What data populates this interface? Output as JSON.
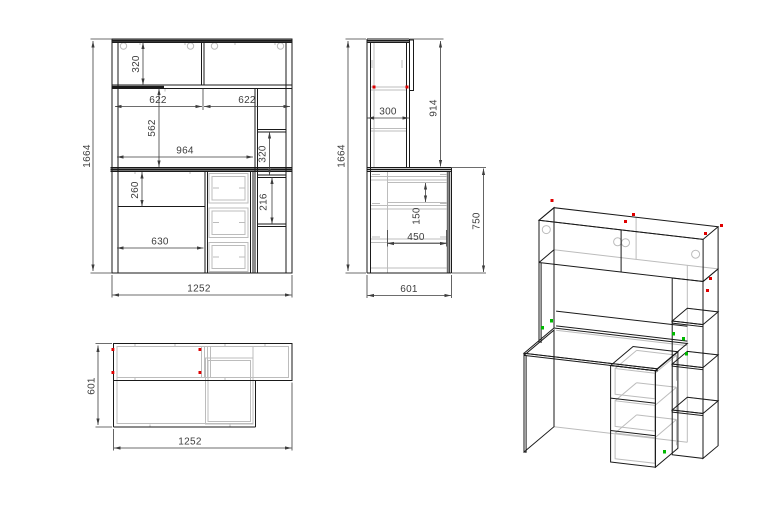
{
  "drawing": {
    "background": "#ffffff",
    "line_color": "#1a1a1a",
    "hidden_line_color": "#bcbcbc",
    "dimension_color": "#3d3d3d",
    "accent_red": "#e00000",
    "accent_green": "#00b800",
    "views": {
      "front_view": {
        "dims": {
          "overall_height": "1664",
          "hutch_height": "320",
          "left_door_width": "622",
          "right_door_width": "622",
          "mid_opening_height": "562",
          "worktop_opening_width": "964",
          "under_desk_height": "260",
          "kneehole_width": "630",
          "shelf_gap_upper": "320",
          "shelf_gap_lower": "216",
          "overall_width": "1252"
        }
      },
      "side_view": {
        "dims": {
          "overall_height": "1664",
          "hutch_depth": "300",
          "above_desk_height": "914",
          "drawer_box_height": "150",
          "drawer_depth": "450",
          "desk_height": "750",
          "overall_depth": "601"
        }
      },
      "top_view": {
        "dims": {
          "overall_depth": "601",
          "overall_width": "1252"
        }
      }
    }
  }
}
